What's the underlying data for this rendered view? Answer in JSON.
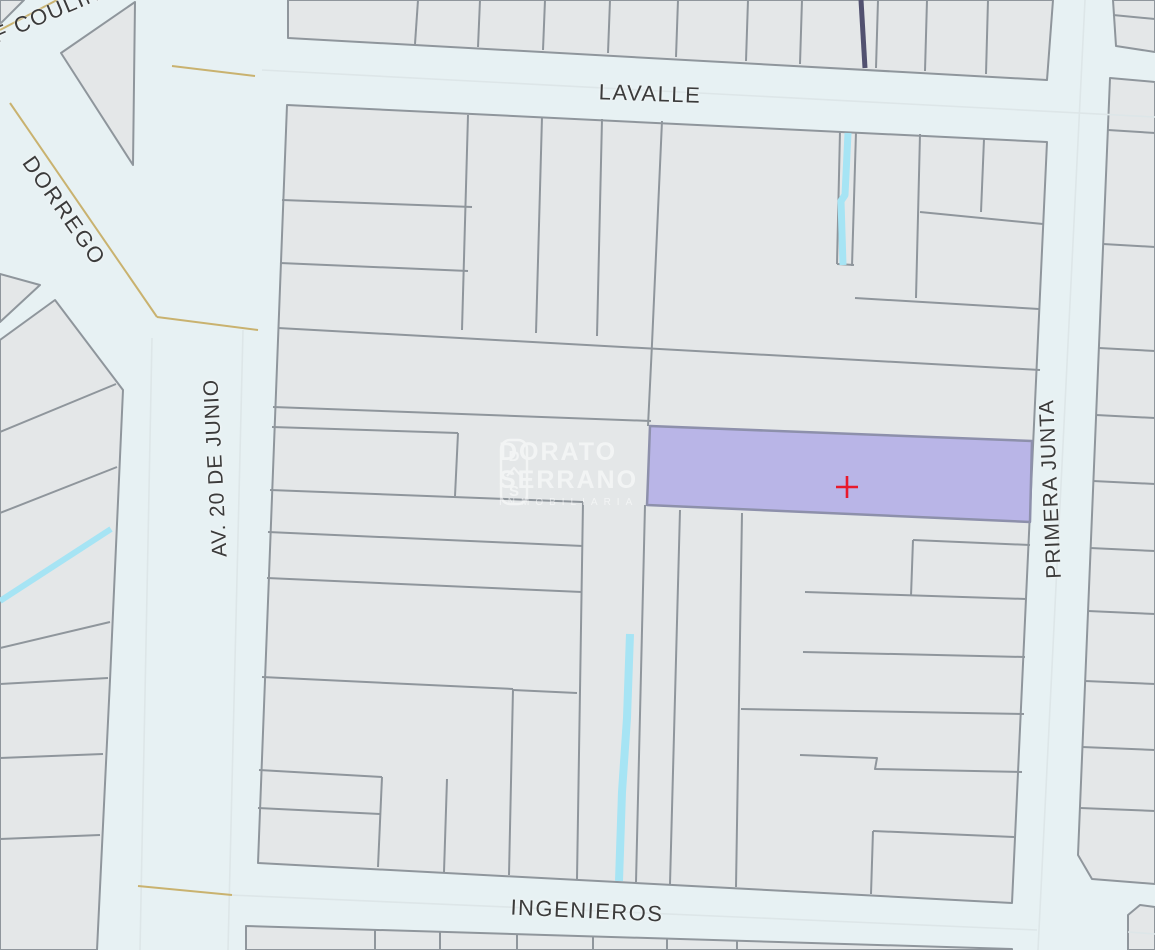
{
  "map": {
    "streets": {
      "f_coulin": ". F COULIN",
      "dorrego": "DORREGO",
      "lavalle": "LAVALLE",
      "av_20_de_junio": "AV. 20 DE JUNIO",
      "primera_junta": "PRIMERA JUNTA",
      "ingenieros": "INGENIEROS"
    },
    "watermark": {
      "line1": "DORATO",
      "line2": "SERRANO",
      "line3": "INMOBILIARIA",
      "logo_letter_top": "D",
      "logo_letter_bottom": "S"
    },
    "marker": {
      "type": "cross"
    }
  },
  "colors": {
    "street-bg": "#e7f1f3",
    "parcel-fill": "#e4e7e8",
    "parcel-stroke": "#8f969c",
    "highlight-fill": "#b9b5e7",
    "highlight-stroke": "#8d90ab",
    "marker-red": "#e8192c",
    "water-cyan": "#a6e4f4",
    "boundary-tan": "#c9b26f",
    "railway-navy": "#515170",
    "centerline": "#dde6e8",
    "label-text": "#3b3b3b",
    "watermark-white": "#ffffff"
  }
}
